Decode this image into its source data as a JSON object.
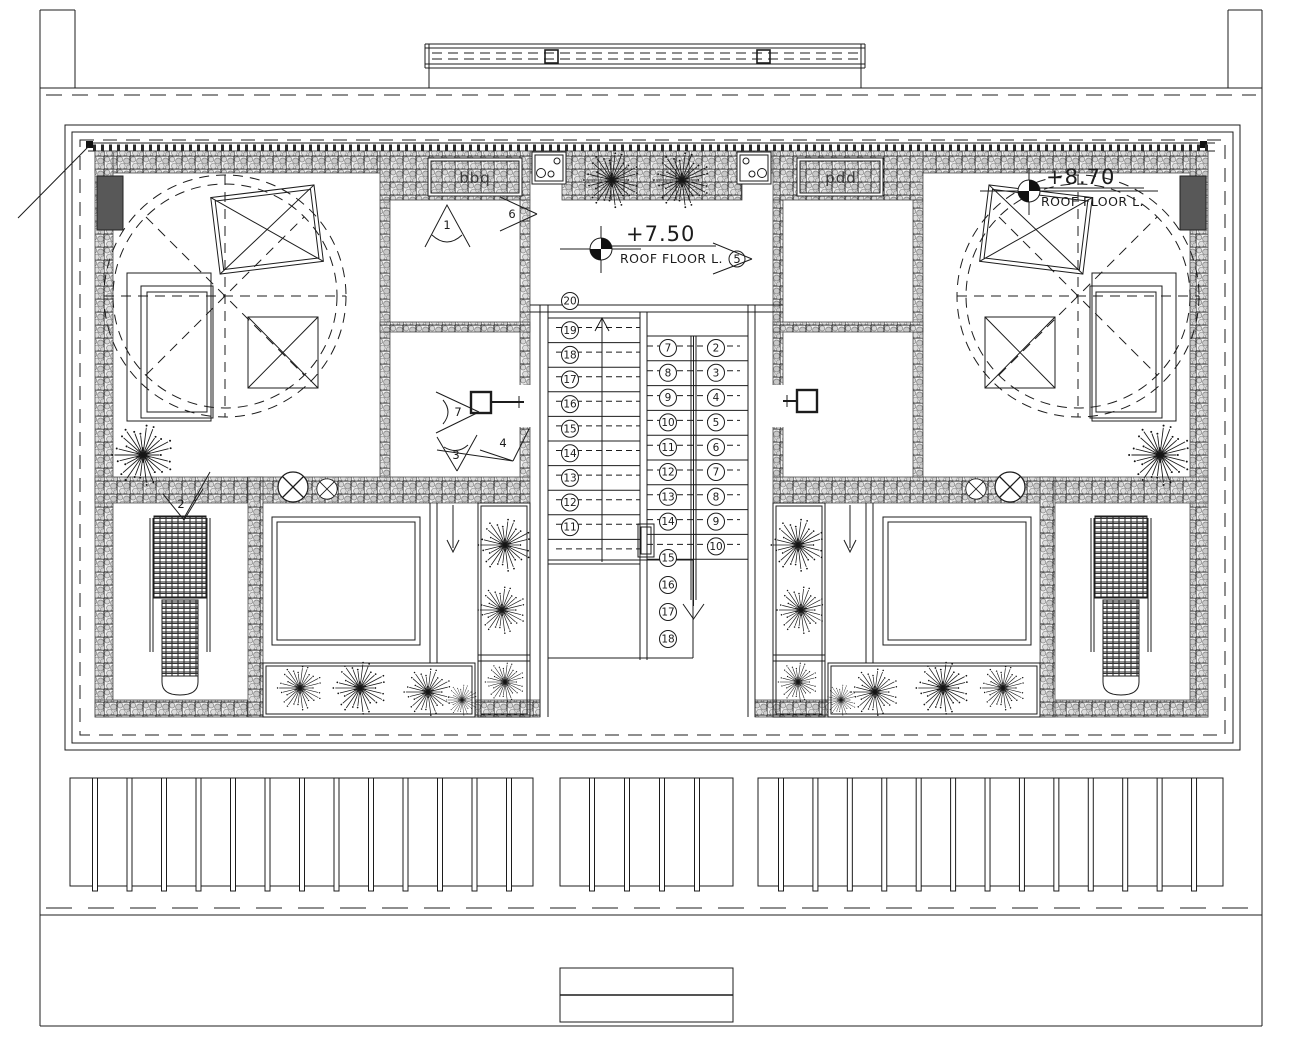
{
  "levels": {
    "center": {
      "value": "+7.50",
      "label": "ROOF FLOOR L."
    },
    "right": {
      "value": "+8.70",
      "label": "ROOF FLOOR L."
    }
  },
  "labels": {
    "bbq_left": "bbq",
    "bbq_right": "bbq"
  },
  "view_markers": {
    "m1": "1",
    "m2": "2",
    "m3": "3",
    "m4": "4",
    "m5": "5",
    "m6": "6",
    "m7": "7"
  },
  "stairs": {
    "left_flight_numbers": [
      "20",
      "19",
      "18",
      "17",
      "16",
      "15",
      "14",
      "13",
      "12",
      "11"
    ],
    "inner_flight_numbers": [
      "7",
      "8",
      "9",
      "10",
      "11",
      "12",
      "13",
      "14"
    ],
    "outer_flight_numbers": [
      "2",
      "3",
      "4",
      "5",
      "6",
      "7",
      "8",
      "9",
      "10"
    ],
    "lower_flight_numbers": [
      "15",
      "16",
      "17",
      "18"
    ]
  },
  "colors": {
    "line": "#1c1c1c",
    "column_fill": "#585858",
    "hatch_pebble": "#cccccc"
  }
}
